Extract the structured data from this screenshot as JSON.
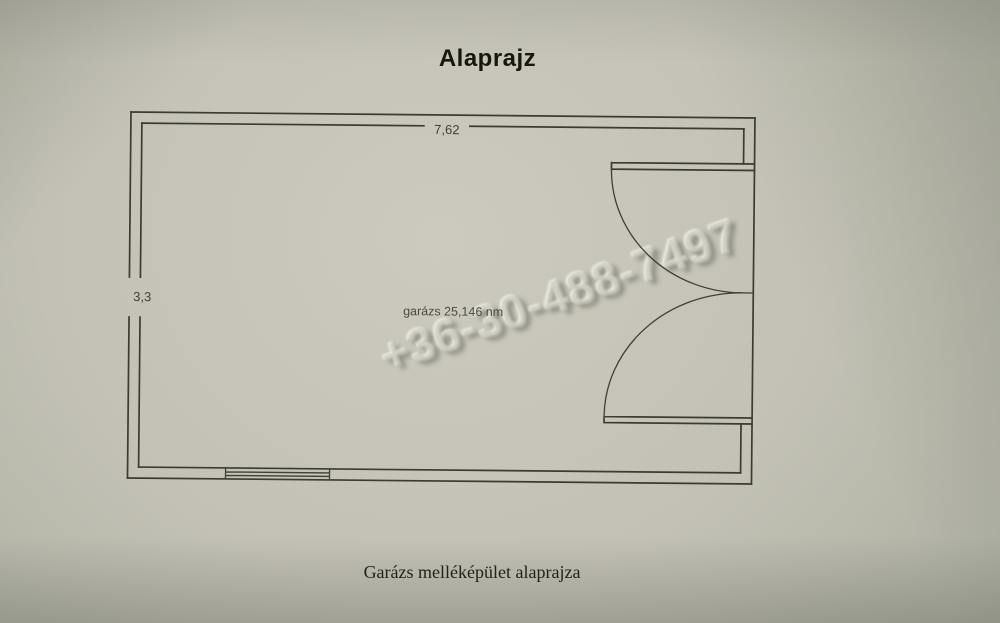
{
  "document": {
    "title": "Alaprajz",
    "caption": "Garázs melléképület alaprajza",
    "watermark_phone": "+36-30-488-7497"
  },
  "floor_plan": {
    "width_dimension": "7,62",
    "height_dimension": "3,3",
    "room_label": "garázs 25,146 nm",
    "features": [
      "double-door-right-wall",
      "window-bottom-wall"
    ]
  },
  "colors": {
    "paper_center": "#cccabe",
    "paper_edge": "#979a8d",
    "line": "#3b3b32",
    "title_text": "#17170f"
  }
}
